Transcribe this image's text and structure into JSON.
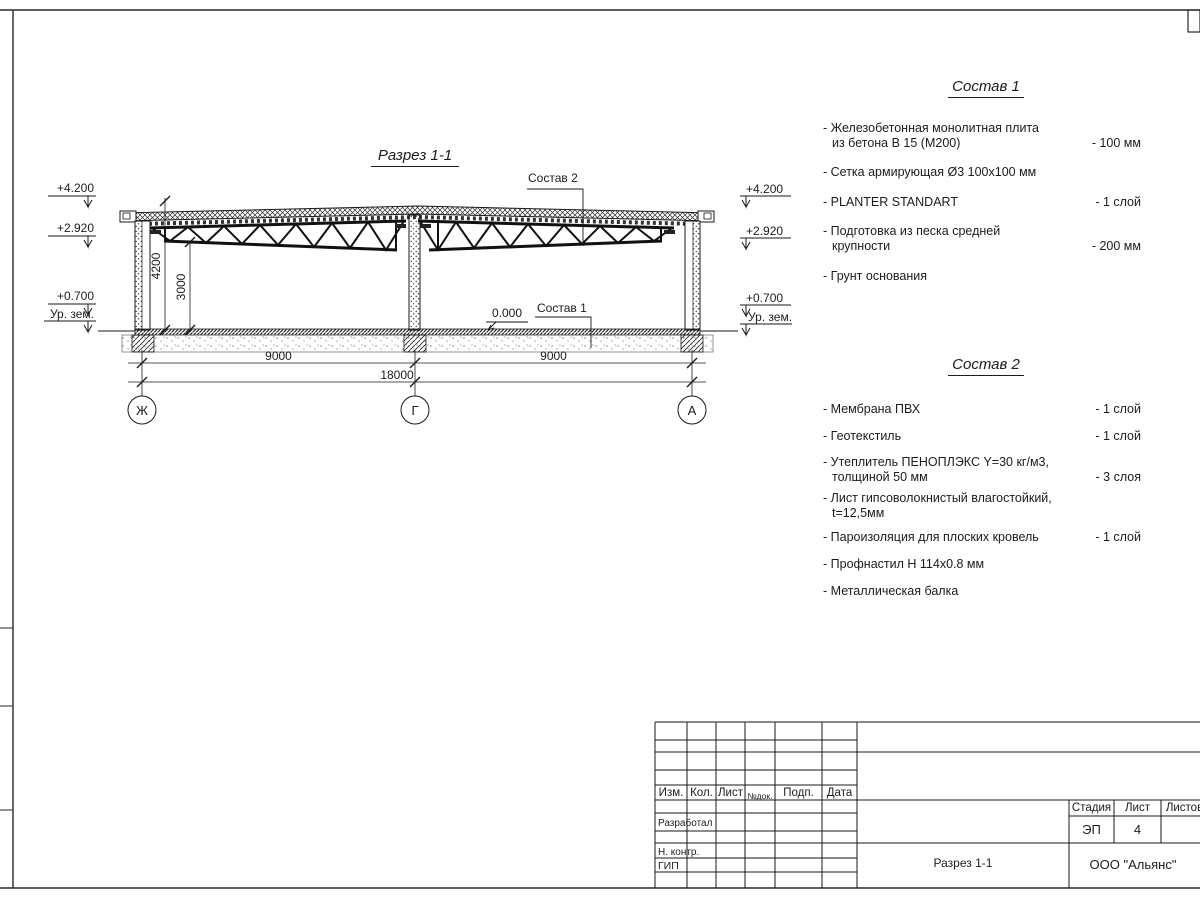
{
  "drawing": {
    "title": "Разрез 1-1",
    "labels": {
      "sostav2_ref": "Состав 2",
      "sostav1_ref": "Состав 1",
      "zero_level": "0.000"
    },
    "elevations": {
      "roof": "+4.200",
      "truss": "+2.920",
      "mid": "+0.700",
      "ground": "Ур. зем."
    },
    "dims": {
      "bay1": "9000",
      "bay2": "9000",
      "total": "18000",
      "height_roof": "4200",
      "height_clear": "3000"
    },
    "axes": {
      "left": "Ж",
      "center": "Г",
      "right": "А"
    }
  },
  "sostav1": {
    "title": "Состав 1",
    "items": [
      {
        "l1": "- Железобетонная  монолитная плита",
        "l2": "из бетона В 15 (М200)",
        "val": "- 100 мм"
      },
      {
        "l1": "- Сетка армирующая Ø3 100х100 мм",
        "l2": "",
        "val": ""
      },
      {
        "l1": "- PLANTER STANDART",
        "l2": "",
        "val": "-  1 слой"
      },
      {
        "l1": "- Подготовка из песка средней",
        "l2": "крупности",
        "val": "- 200 мм"
      },
      {
        "l1": "- Грунт основания",
        "l2": "",
        "val": ""
      }
    ]
  },
  "sostav2": {
    "title": "Состав 2",
    "items": [
      {
        "l1": "- Мембрана ПВХ",
        "l2": "",
        "val": "- 1 слой"
      },
      {
        "l1": "- Геотекстиль",
        "l2": "",
        "val": "- 1 слой"
      },
      {
        "l1": "- Утеплитель ПЕНОПЛЭКС Y=30 кг/м3,",
        "l2": "толщиной 50 мм",
        "val": "- 3 слоя"
      },
      {
        "l1": "- Лист гипсоволокнистый влагостойкий,",
        "l2": "t=12,5мм",
        "val": ""
      },
      {
        "l1": "- Пароизоляция для плоских кровель",
        "l2": "",
        "val": "- 1 слой"
      },
      {
        "l1": "- Профнастил Н 114х0.8 мм",
        "l2": "",
        "val": ""
      },
      {
        "l1": "- Металлическая балка",
        "l2": "",
        "val": ""
      }
    ]
  },
  "title_block": {
    "cols": {
      "izm": "Изм.",
      "kol": "Кол.",
      "list": "Лист",
      "ndok": "№док.",
      "podp": "Подп.",
      "data": "Дата"
    },
    "roles": {
      "developed": "Разработал",
      "ncontr": "Н. контр.",
      "gip": "ГИП"
    },
    "stage": {
      "label": "Стадия",
      "value": "ЭП"
    },
    "sheet": {
      "label": "Лист",
      "value": "4"
    },
    "sheets": {
      "label": "Листов",
      "value": ""
    },
    "doc_name": "Разрез 1-1",
    "company": "ООО \"Альянс\""
  }
}
